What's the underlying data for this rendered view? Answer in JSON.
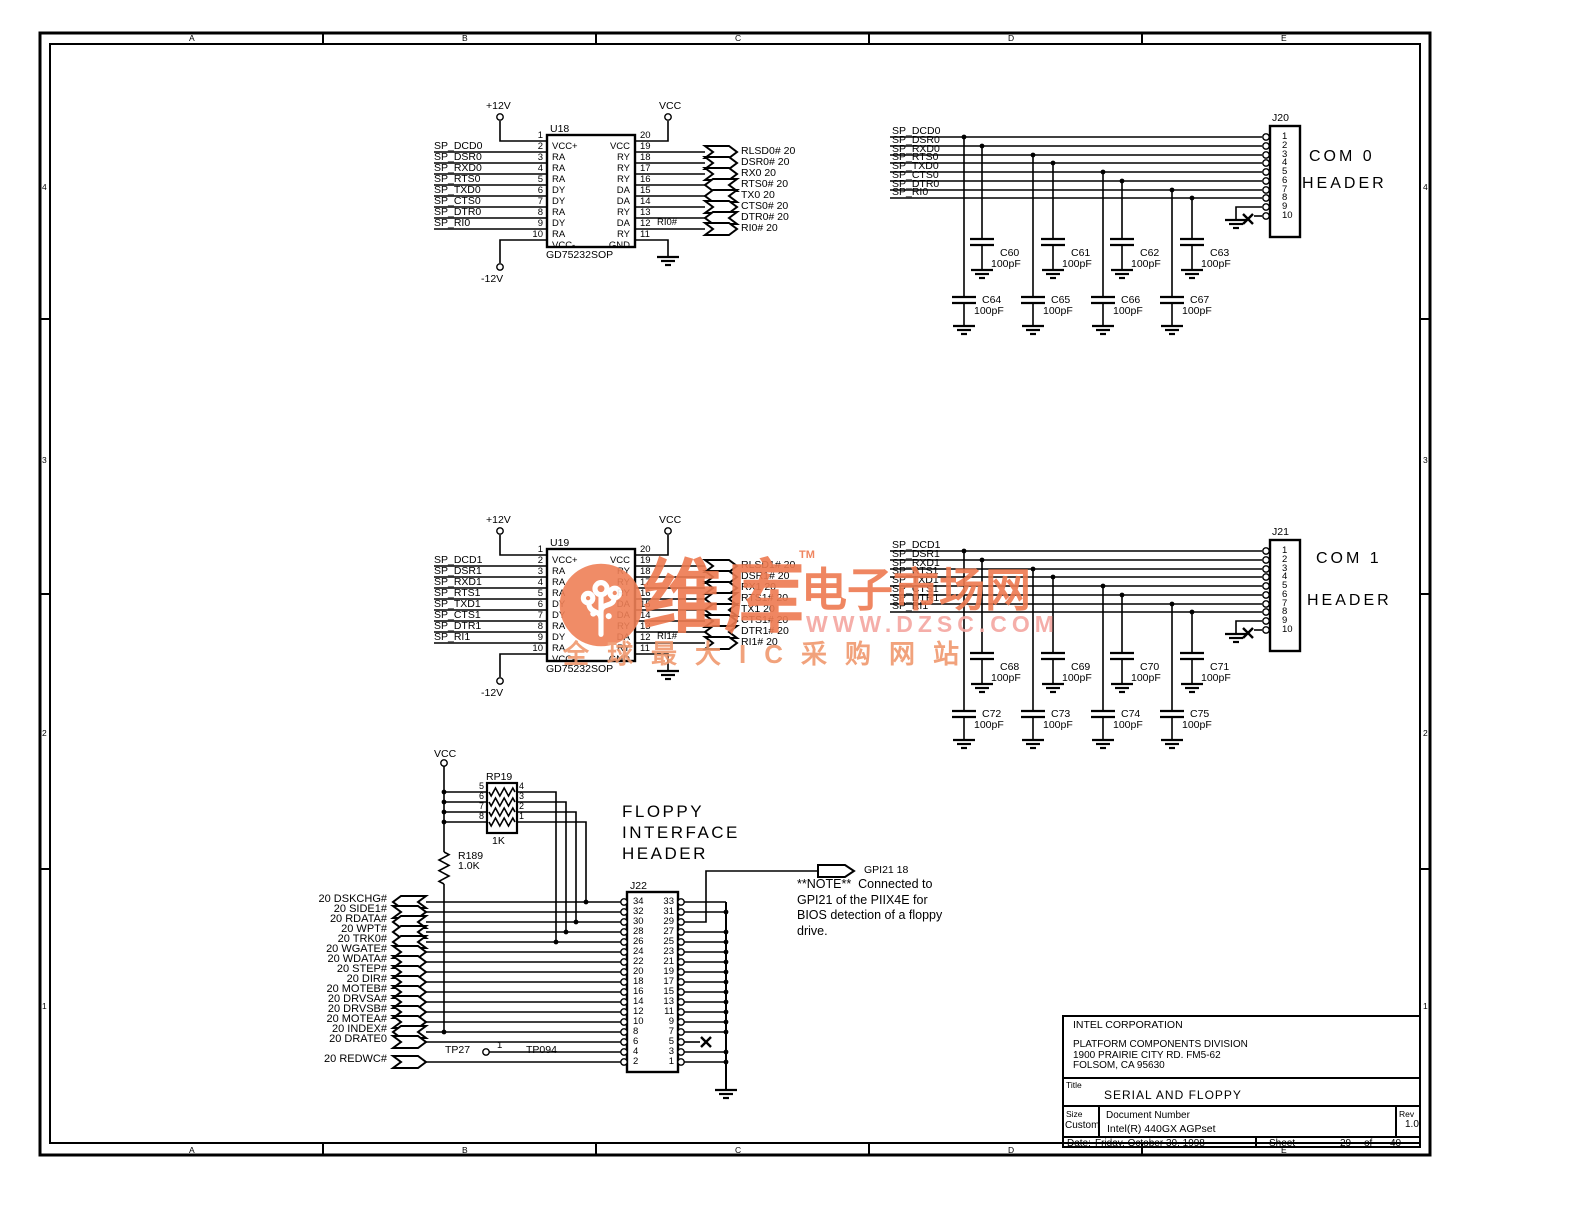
{
  "grid": {
    "cols": [
      "A",
      "B",
      "C",
      "D",
      "E"
    ],
    "rows": [
      "4",
      "3",
      "2",
      "1"
    ]
  },
  "watermark": {
    "brand_big": "维库",
    "tm": "TM",
    "brand_suffix": "电子市场网",
    "url": "WWW.DZSC.COM",
    "tagline": "全球最大IC采购网站",
    "logo_icon": "dzsc-circuit-tree-logo",
    "colors": {
      "primary": "#ee7a50",
      "circle": "#ef8057",
      "url_pink": "#f4a6a0",
      "tagline_orange": "#f0996e"
    }
  },
  "com_sections": [
    {
      "id": "com0",
      "chip": {
        "ref": "U18",
        "part": "GD75232SOP",
        "left_pins": [
          [
            "1",
            "VCC+"
          ],
          [
            "2",
            "RA"
          ],
          [
            "3",
            "RA"
          ],
          [
            "4",
            "RA"
          ],
          [
            "5",
            "DY"
          ],
          [
            "6",
            "DY"
          ],
          [
            "7",
            "RA"
          ],
          [
            "8",
            "DY"
          ],
          [
            "9",
            "RA"
          ],
          [
            "10",
            "VCC-"
          ]
        ],
        "right_pins": [
          [
            "20",
            "VCC"
          ],
          [
            "19",
            "RY"
          ],
          [
            "18",
            "RY"
          ],
          [
            "17",
            "RY"
          ],
          [
            "16",
            "DA"
          ],
          [
            "15",
            "DA"
          ],
          [
            "14",
            "RY"
          ],
          [
            "13",
            "DA"
          ],
          [
            "12",
            "RY"
          ],
          [
            "11",
            "GND"
          ]
        ]
      },
      "power": {
        "vplus": "+12V",
        "vminus": "-12V",
        "vcc": "VCC"
      },
      "chip_inputs": [
        "SP_DCD0",
        "SP_DSR0",
        "SP_RXD0",
        "SP_RTS0",
        "SP_TXD0",
        "SP_CTS0",
        "SP_DTR0",
        "SP_RI0"
      ],
      "chip_outputs": [
        {
          "label": "RLSD0# 20",
          "dir": "right"
        },
        {
          "label": "DSR0# 20",
          "dir": "right"
        },
        {
          "label": "RX0 20",
          "dir": "right"
        },
        {
          "label": "RTS0# 20",
          "dir": "left"
        },
        {
          "label": "TX0 20",
          "dir": "left"
        },
        {
          "label": "CTS0# 20",
          "dir": "right"
        },
        {
          "label": "DTR0# 20",
          "dir": "left"
        },
        {
          "label": "RI0# 20",
          "dir": "right"
        }
      ],
      "wire_label": "RI0#",
      "header": {
        "ref": "J20",
        "title": [
          "COM 0",
          "HEADER"
        ],
        "pins": [
          "1",
          "2",
          "3",
          "4",
          "5",
          "6",
          "7",
          "8",
          "9",
          "10"
        ],
        "signals": [
          "SP_DCD0",
          "SP_DSR0",
          "SP_RXD0",
          "SP_RTS0",
          "SP_TXD0",
          "SP_CTS0",
          "SP_DTR0",
          "SP_RI0"
        ]
      },
      "caps_upper": [
        [
          "C60",
          "100pF"
        ],
        [
          "C61",
          "100pF"
        ],
        [
          "C62",
          "100pF"
        ],
        [
          "C63",
          "100pF"
        ]
      ],
      "caps_lower": [
        [
          "C64",
          "100pF"
        ],
        [
          "C65",
          "100pF"
        ],
        [
          "C66",
          "100pF"
        ],
        [
          "C67",
          "100pF"
        ]
      ]
    },
    {
      "id": "com1",
      "chip": {
        "ref": "U19",
        "part": "GD75232SOP",
        "left_pins": [
          [
            "1",
            "VCC+"
          ],
          [
            "2",
            "RA"
          ],
          [
            "3",
            "RA"
          ],
          [
            "4",
            "RA"
          ],
          [
            "5",
            "DY"
          ],
          [
            "6",
            "DY"
          ],
          [
            "7",
            "RA"
          ],
          [
            "8",
            "DY"
          ],
          [
            "9",
            "RA"
          ],
          [
            "10",
            "VCC-"
          ]
        ],
        "right_pins": [
          [
            "20",
            "VCC"
          ],
          [
            "19",
            "RY"
          ],
          [
            "18",
            "RY"
          ],
          [
            "17",
            "RY"
          ],
          [
            "16",
            "DA"
          ],
          [
            "15",
            "DA"
          ],
          [
            "14",
            "RY"
          ],
          [
            "13",
            "DA"
          ],
          [
            "12",
            "RY"
          ],
          [
            "11",
            "GND"
          ]
        ]
      },
      "power": {
        "vplus": "+12V",
        "vminus": "-12V",
        "vcc": "VCC"
      },
      "chip_inputs": [
        "SP_DCD1",
        "SP_DSR1",
        "SP_RXD1",
        "SP_RTS1",
        "SP_TXD1",
        "SP_CTS1",
        "SP_DTR1",
        "SP_RI1"
      ],
      "chip_outputs": [
        {
          "label": "RLSD1# 20",
          "dir": "right"
        },
        {
          "label": "DSR1# 20",
          "dir": "right"
        },
        {
          "label": "RX1 20",
          "dir": "right"
        },
        {
          "label": "RTS1# 20",
          "dir": "left"
        },
        {
          "label": "TX1 20",
          "dir": "left"
        },
        {
          "label": "CTS1# 20",
          "dir": "right"
        },
        {
          "label": "DTR1# 20",
          "dir": "left"
        },
        {
          "label": "RI1# 20",
          "dir": "right"
        }
      ],
      "wire_label": "RI1#",
      "header": {
        "ref": "J21",
        "title": [
          "COM 1",
          "HEADER"
        ],
        "pins": [
          "1",
          "2",
          "3",
          "4",
          "5",
          "6",
          "7",
          "8",
          "9",
          "10"
        ],
        "signals": [
          "SP_DCD1",
          "SP_DSR1",
          "SP_RXD1",
          "SP_RTS1",
          "SP_TXD1",
          "SP_CTS1",
          "SP_DTR1",
          "SP_RI1"
        ]
      },
      "caps_upper": [
        [
          "C68",
          "100pF"
        ],
        [
          "C69",
          "100pF"
        ],
        [
          "C70",
          "100pF"
        ],
        [
          "C71",
          "100pF"
        ]
      ],
      "caps_lower": [
        [
          "C72",
          "100pF"
        ],
        [
          "C73",
          "100pF"
        ],
        [
          "C74",
          "100pF"
        ],
        [
          "C75",
          "100pF"
        ]
      ]
    }
  ],
  "floppy": {
    "title_lines": [
      "FLOPPY",
      "INTERFACE",
      "HEADER"
    ],
    "vcc": "VCC",
    "rpack": {
      "ref": "RP19",
      "value": "1K",
      "left_pins": [
        "5",
        "6",
        "7",
        "8"
      ],
      "right_pins": [
        "4",
        "3",
        "2",
        "1"
      ]
    },
    "resistor": {
      "ref": "R189",
      "value": "1.0K"
    },
    "header": {
      "ref": "J22",
      "left_pins": [
        "34",
        "32",
        "30",
        "28",
        "26",
        "24",
        "22",
        "20",
        "18",
        "16",
        "14",
        "12",
        "10",
        "8",
        "6",
        "4",
        "2"
      ],
      "right_pins": [
        "33",
        "31",
        "29",
        "27",
        "25",
        "23",
        "21",
        "19",
        "17",
        "15",
        "13",
        "11",
        "9",
        "7",
        "5",
        "3",
        "1"
      ]
    },
    "signals": [
      {
        "label": "20 DSKCHG#",
        "dir": "left"
      },
      {
        "label": "20 SIDE1#",
        "dir": "right"
      },
      {
        "label": "20 RDATA#",
        "dir": "left"
      },
      {
        "label": "20 WPT#",
        "dir": "left"
      },
      {
        "label": "20 TRK0#",
        "dir": "left"
      },
      {
        "label": "20 WGATE#",
        "dir": "right"
      },
      {
        "label": "20 WDATA#",
        "dir": "right"
      },
      {
        "label": "20 STEP#",
        "dir": "right"
      },
      {
        "label": "20 DIR#",
        "dir": "right"
      },
      {
        "label": "20 MOTEB#",
        "dir": "right"
      },
      {
        "label": "20 DRVSA#",
        "dir": "right"
      },
      {
        "label": "20 DRVSB#",
        "dir": "right"
      },
      {
        "label": "20 MOTEA#",
        "dir": "right"
      },
      {
        "label": "20 INDEX#",
        "dir": "left"
      },
      {
        "label": "20 DRATE0",
        "dir": "right"
      },
      {
        "label": "20 REDWC#",
        "dir": "right"
      }
    ],
    "testpoints": {
      "tp27": "TP27",
      "pin_label": "1",
      "tp094": "TP094"
    },
    "gpio": {
      "label": "GPI21 18"
    },
    "note_lines": [
      "**NOTE**  Connected to",
      "GPI21 of the PIIX4E for",
      "BIOS detection of a floppy",
      "drive."
    ]
  },
  "title_block": {
    "company": "INTEL CORPORATION",
    "division": "PLATFORM COMPONENTS DIVISION",
    "address1": "1900 PRAIRIE CITY RD. FM5-62",
    "address2": "FOLSOM, CA 95630",
    "title_label": "Title",
    "title": "SERIAL AND FLOPPY",
    "size_label": "Size",
    "size": "Custom",
    "doc_label": "Document Number",
    "doc": "Intel(R) 440GX AGPset",
    "rev_label": "Rev",
    "rev": "1.0",
    "date_label": "Date:",
    "date": "Friday, October 30, 1998",
    "sheet_label": "Sheet",
    "sheet": "29",
    "of_label": "of",
    "total": "40"
  }
}
